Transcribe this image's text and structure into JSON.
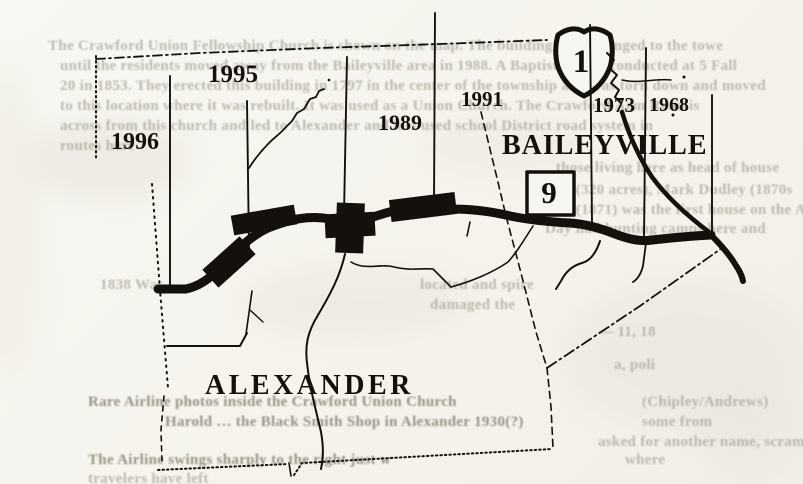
{
  "document": {
    "kind": "scanned hand-drawn town map with show-through text",
    "towns_shown": [
      "BAILEYVILLE",
      "ALEXANDER"
    ]
  },
  "map": {
    "towns": {
      "baileyville": "BAILEYVILLE",
      "alexander": "ALEXANDER"
    },
    "years": {
      "y1995": "1995",
      "y1991": "1991",
      "y1989": "1989",
      "y1996": "1996",
      "y1973": "1973",
      "y1968": "1968"
    },
    "route_shield": {
      "shape": "us-route-shield",
      "number": "1"
    },
    "route_box": {
      "shape": "state-route-box",
      "number": "9"
    }
  },
  "colors": {
    "ink": "#14110c",
    "paper": "#f6f4ee",
    "bleed_text": "#9d978a"
  },
  "bleed_text": {
    "note": "faint text showing through from the reverse page; partially legible",
    "lines": [
      {
        "x": 48,
        "y": 38,
        "text": "The Crawford Union Fellowship Church is shown on the map. The building had belonged to the towe"
      },
      {
        "x": 60,
        "y": 58,
        "text": "until the residents moved away from the Baileyville area in 1988. A Baptist census conducted at 5 Fall"
      },
      {
        "x": 60,
        "y": 78,
        "text": "20 in 1853. They erected this building in 1797 in the center of the township and was torn down and moved"
      },
      {
        "x": 60,
        "y": 98,
        "text": "to this location where it was rebuilt. It was used as a Union Church. The Crawford Arm Road is"
      },
      {
        "x": 60,
        "y": 118,
        "text": "across from this church and led to Alexander and last used school District road system in"
      },
      {
        "x": 60,
        "y": 138,
        "text": "routes here"
      },
      {
        "x": 556,
        "y": 160,
        "text": "those living here as head of house"
      },
      {
        "x": 545,
        "y": 182,
        "text": "Day (320 acres), Mark Dudley (1870s"
      },
      {
        "x": 545,
        "y": 202,
        "text": "Day (1871) was the first house on the Airline"
      },
      {
        "x": 545,
        "y": 221,
        "text": "Day had hunting camps here and"
      },
      {
        "x": 100,
        "y": 277,
        "text": "1838 Was"
      },
      {
        "x": 420,
        "y": 277,
        "text": "located and spire"
      },
      {
        "x": 430,
        "y": 297,
        "text": "damaged the"
      },
      {
        "x": 598,
        "y": 324,
        "text": "— 11, 18"
      },
      {
        "x": 614,
        "y": 357,
        "text": "a, poli"
      },
      {
        "x": 88,
        "y": 394,
        "text": "Rare Airline photos inside the Crawford Union Church",
        "dark": true
      },
      {
        "x": 642,
        "y": 394,
        "text": "(Chipley/Andrews)"
      },
      {
        "x": 165,
        "y": 414,
        "text": "Harold … the Black Smith Shop in Alexander 1930(?)",
        "dark": true
      },
      {
        "x": 642,
        "y": 414,
        "text": "some from"
      },
      {
        "x": 598,
        "y": 434,
        "text": "asked for another name, scrambled"
      },
      {
        "x": 88,
        "y": 452,
        "text": "The Airline swings sharply to the right just w",
        "dark": true
      },
      {
        "x": 625,
        "y": 452,
        "text": "where"
      },
      {
        "x": 88,
        "y": 471,
        "text": "travelers have left"
      }
    ]
  }
}
